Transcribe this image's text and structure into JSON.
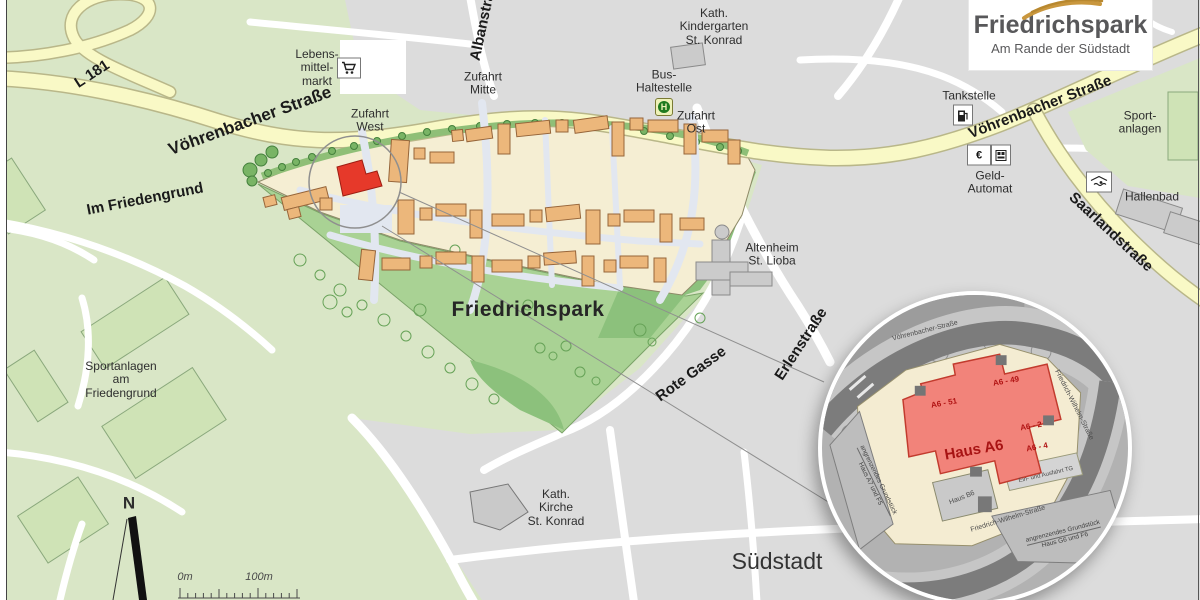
{
  "logo": {
    "title": "Friedrichspark",
    "subtitle": "Am Rande der Südstadt"
  },
  "streets": {
    "l181": "L 181",
    "voehrenbacher_west": "Vöhrenbacher Straße",
    "voehrenbacher_east": "Vöhrenbacher Straße",
    "im_friedengrund": "Im Friedengrund",
    "albanstrasse": "Albanstraße",
    "saarlandstrasse": "Saarlandstraße",
    "rote_gasse": "Rote Gasse",
    "erlenstrasse": "Erlenstraße"
  },
  "labels": {
    "lebensmittelmarkt": [
      "Lebens-",
      "mittel-",
      "markt"
    ],
    "zufahrt_west": [
      "Zufahrt",
      "West"
    ],
    "zufahrt_mitte": [
      "Zufahrt",
      "Mitte"
    ],
    "zufahrt_ost": [
      "Zufahrt",
      "Ost"
    ],
    "kindergarten": [
      "Kath.",
      "Kindergarten",
      "St. Konrad"
    ],
    "bus_haltestelle": [
      "Bus-",
      "Haltestelle"
    ],
    "bus_icon_letter": "H",
    "tankstelle": "Tankstelle",
    "geld_automat": [
      "Geld-",
      "Automat"
    ],
    "geld_icon_symbol": "€",
    "sportanlagen_ost": [
      "Sport-",
      "anlagen"
    ],
    "hallenbad": "Hallenbad",
    "altenheim": [
      "Altenheim",
      "St. Lioba"
    ],
    "friedrichspark": "Friedrichspark",
    "sportanlagen_west": [
      "Sportanlagen",
      "am",
      "Friedengrund"
    ],
    "kirche": [
      "Kath.",
      "Kirche",
      "St. Konrad"
    ],
    "suedstadt": "Südstadt"
  },
  "inset": {
    "haus_a6": "Haus A6",
    "a6_51": "A6 - 51",
    "a6_49": "A6 - 49",
    "a6_2": "A6 - 2",
    "a6_4": "A6 - 4",
    "haus_b6": "Haus B6",
    "ramp": "Ein- und Ausfahrt TG",
    "street_top": "Vöhrenbacher-Straße",
    "street_right": "Friedrich-Wilhelm-Straße",
    "street_bottom": "Friedrich-Wilhelm-Straße",
    "neighbor_left": [
      "angrenzendes Grundstück",
      "Haus A7 und F5"
    ],
    "neighbor_bottom": [
      "angrenzendes Grundstück",
      "Haus G6 und F6"
    ]
  },
  "controls": {
    "compass": "N",
    "scale_start": "0m",
    "scale_end": "100m"
  },
  "colors": {
    "bg_green": "#d9e6c6",
    "urban_gray": "#dcdcdc",
    "park_green": "#a9d294",
    "road_yellow": "#f9f9c6",
    "cream": "#f5eed3",
    "building_orange": "#ecb77b",
    "highlight_red": "#e6392a",
    "logo_gold": "#c9973e",
    "logo_text": "#58585a"
  }
}
